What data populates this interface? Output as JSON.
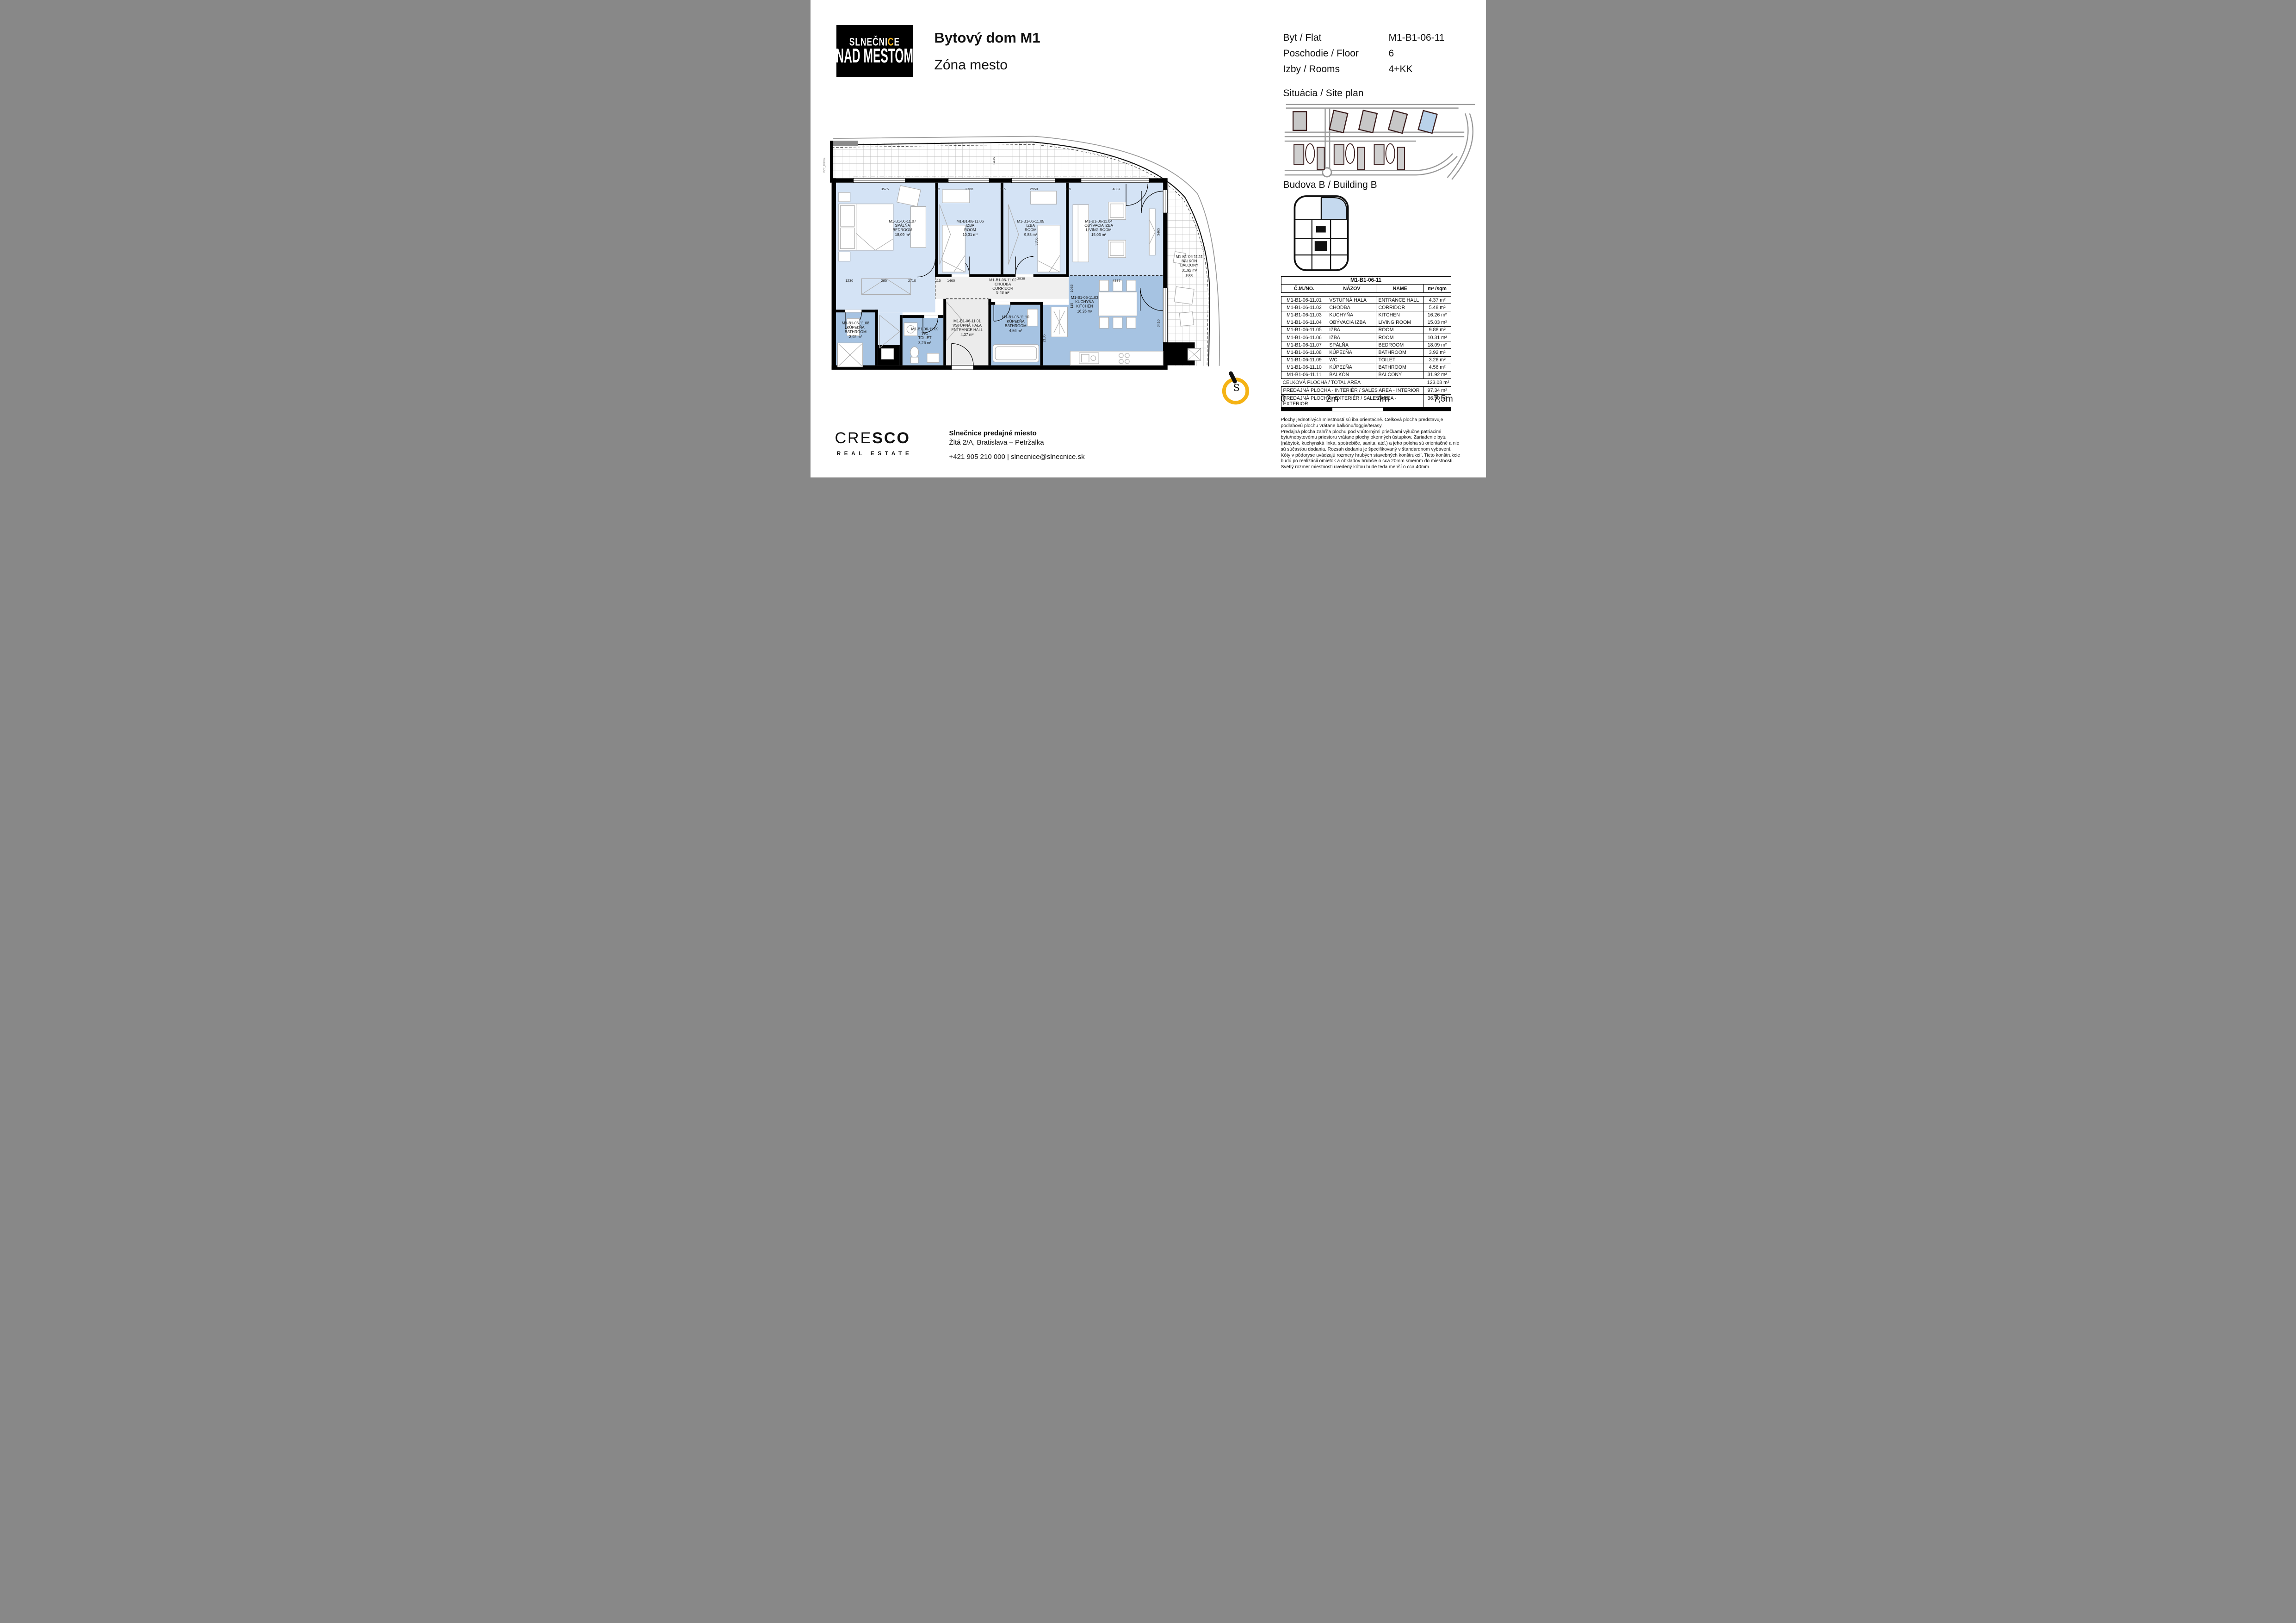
{
  "header": {
    "logo": {
      "part1": "SLNEČNI",
      "c": "C",
      "part2": "E",
      "line2": "NAD MESTOM"
    },
    "title_line1": "Bytový dom  M1",
    "title_line2": "Zóna mesto",
    "info_rows": [
      {
        "label": "Byt / Flat",
        "value": "M1-B1-06-11"
      },
      {
        "label": "Poschodie / Floor",
        "value": "6"
      },
      {
        "label": "Izby / Rooms",
        "value": "4+KK"
      }
    ]
  },
  "site": {
    "heading": "Situácia / Site plan"
  },
  "building": {
    "heading": "Budova B / Building B"
  },
  "plan": {
    "rooms": [
      {
        "code": "M1-B1-06-11.01",
        "sk": "VSTUPNÁ HALA",
        "en": "ENTRANCE HALL",
        "area_plan": "4,37 m²",
        "area_table": "4.37 m²"
      },
      {
        "code": "M1-B1-06-11.02",
        "sk": "CHODBA",
        "en": "CORRIDOR",
        "area_plan": "5,48 m²",
        "area_table": "5.48 m²"
      },
      {
        "code": "M1-B1-06-11.03",
        "sk": "KUCHYŇA",
        "en": "KITCHEN",
        "area_plan": "16,26 m²",
        "area_table": "16.26 m²"
      },
      {
        "code": "M1-B1-06-11.04",
        "sk": "OBÝVACIA IZBA",
        "en": "LIVING ROOM",
        "area_plan": "15,03 m²",
        "area_table": "15.03 m²"
      },
      {
        "code": "M1-B1-06-11.05",
        "sk": "IZBA",
        "en": "ROOM",
        "area_plan": "9,88 m²",
        "area_table": "9.88 m²"
      },
      {
        "code": "M1-B1-06-11.06",
        "sk": "IZBA",
        "en": "ROOM",
        "area_plan": "10,31 m²",
        "area_table": "10.31 m²"
      },
      {
        "code": "M1-B1-06-11.07",
        "sk": "SPÁLŇA",
        "en": "BEDROOM",
        "area_plan": "18,09 m²",
        "area_table": "18.09 m²"
      },
      {
        "code": "M1-B1-06-11.08",
        "sk": "KÚPEĽŇA",
        "en": "BATHROOM",
        "area_plan": "3,92 m²",
        "area_table": "3.92 m²"
      },
      {
        "code": "M1-B1-06-11.09",
        "sk": "WC",
        "en": "TOILET",
        "area_plan": "3,26 m²",
        "area_table": "3.26 m²"
      },
      {
        "code": "M1-B1-06-11.10",
        "sk": "KÚPEĽŇA",
        "en": "BATHROOM",
        "area_plan": "4,56 m²",
        "area_table": "4.56 m²"
      },
      {
        "code": "M1-B1-06-11.11",
        "sk": "BALKÓN",
        "en": "BALCONY",
        "area_plan": "31,92 m²",
        "area_table": "31.92 m²"
      }
    ],
    "dims": [
      "3575",
      "115",
      "2768",
      "115",
      "2950",
      "115",
      "4337",
      "3465",
      "3350",
      "1230",
      "285",
      "2710",
      "115",
      "1460",
      "3838",
      "1035",
      "4337",
      "3410",
      "2185",
      "1660",
      "1435",
      "115"
    ],
    "vzt": "VZT_Klima."
  },
  "table": {
    "title": "M1-B1-06-11",
    "columns": [
      "Č.M./NO.",
      "NÁZOV",
      "NAME",
      "m² /sqm"
    ],
    "total": {
      "label": "CELKOVÁ PLOCHA / TOTAL AREA",
      "value": "123.08 m²"
    },
    "sales": [
      {
        "label": "PREDAJNÁ PLOCHA - INTERIÉR / SALES AREA - INTERIOR",
        "value": "97.34 m²"
      },
      {
        "label": "PREDAJNÁ PLOCHA - EXTERIÉR / SALES AREA - EXTERIOR",
        "value": "36.50 m²"
      }
    ]
  },
  "scalebar": {
    "labels": [
      "0",
      "2m",
      "4m",
      "7,5m"
    ]
  },
  "compass": {
    "letter": "S"
  },
  "disclaimer": {
    "p1": "Plochy jednotlivých miestností sú iba orientačné. Celková plocha predstavuje podlahovú plochu vrátane balkónu/loggie/terasy.",
    "p2": "Predajná plocha zahŕňa plochu pod vnútornými priečkami výlučne patriacimi bytu/nebytovému priestoru vrátane plochy okenných ústupkov. Zariadenie bytu (nábytok, kuchynská linka, spotrebiče, sanita, atď.) a jeho poloha sú orientačné a nie sú súčasťou dodania. Rozsah dodania je špecifikovaný v štandardnom vybavení.",
    "p3": "Kóty v pôdoryse uvádzajú rozmery hrubých stavebných konštrukcií. Tieto konštrukcie budú po realizácii omietok a obkladov hrubšie o cca 20mm smerom do miestnosti. Svetlý rozmer miestnosti uvedený kótou bude teda menší o cca 40mm."
  }
}
